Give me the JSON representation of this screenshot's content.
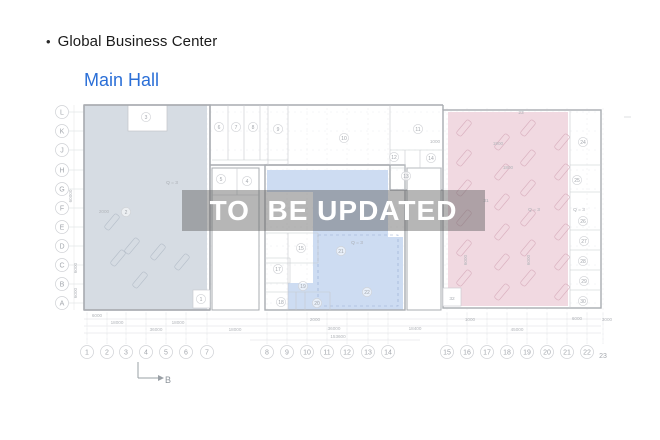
{
  "header": {
    "bullet": "•",
    "title": "Global Business Center",
    "subtitle": "Main Hall",
    "subtitle_color": "#2b6fd7"
  },
  "watermark": {
    "text": "TO  BE UPDATED"
  },
  "plan": {
    "colors": {
      "left_zone": "#d6dce3",
      "mid_zone": "#cddcf2",
      "right_zone": "#f1d9e1",
      "wall": "#a9acb1",
      "partition": "#c6c9cd",
      "grid": "#ebecee",
      "axis_stroke": "#cfd1d5",
      "axis_text": "#a3a7ad",
      "dim_text": "#b2b5ba",
      "note_text": "#a9adb3",
      "hatch_left": "#b6bfca",
      "hatch_pink": "#d9afbe",
      "dash_blue": "#97abd0"
    },
    "row_axis": [
      {
        "label": "L",
        "y": 112
      },
      {
        "label": "K",
        "y": 131
      },
      {
        "label": "J",
        "y": 150
      },
      {
        "label": "H",
        "y": 170
      },
      {
        "label": "G",
        "y": 189
      },
      {
        "label": "F",
        "y": 208
      },
      {
        "label": "E",
        "y": 227
      },
      {
        "label": "D",
        "y": 246
      },
      {
        "label": "C",
        "y": 265
      },
      {
        "label": "B",
        "y": 284
      },
      {
        "label": "A",
        "y": 303
      }
    ],
    "col_axis": [
      {
        "label": "1",
        "x": 87
      },
      {
        "label": "2",
        "x": 107
      },
      {
        "label": "3",
        "x": 126
      },
      {
        "label": "4",
        "x": 146
      },
      {
        "label": "5",
        "x": 166
      },
      {
        "label": "6",
        "x": 186
      },
      {
        "label": "7",
        "x": 207
      },
      {
        "label": "8",
        "x": 267
      },
      {
        "label": "9",
        "x": 287
      },
      {
        "label": "10",
        "x": 307
      },
      {
        "label": "11",
        "x": 327
      },
      {
        "label": "12",
        "x": 347
      },
      {
        "label": "13",
        "x": 368
      },
      {
        "label": "14",
        "x": 388
      },
      {
        "label": "15",
        "x": 447
      },
      {
        "label": "16",
        "x": 467
      },
      {
        "label": "17",
        "x": 487
      },
      {
        "label": "18",
        "x": 507
      },
      {
        "label": "19",
        "x": 527
      },
      {
        "label": "20",
        "x": 547
      },
      {
        "label": "21",
        "x": 567
      },
      {
        "label": "22",
        "x": 587
      },
      {
        "label": "23",
        "x": 603,
        "plain": true
      }
    ],
    "rooms": [
      {
        "n": "1",
        "x": 201,
        "y": 299
      },
      {
        "n": "2",
        "x": 126,
        "y": 212
      },
      {
        "n": "3",
        "x": 146,
        "y": 117
      },
      {
        "n": "4",
        "x": 247,
        "y": 181
      },
      {
        "n": "5",
        "x": 221,
        "y": 179
      },
      {
        "n": "6",
        "x": 219,
        "y": 127
      },
      {
        "n": "7",
        "x": 236,
        "y": 127
      },
      {
        "n": "8",
        "x": 253,
        "y": 127
      },
      {
        "n": "9",
        "x": 278,
        "y": 129
      },
      {
        "n": "10",
        "x": 344,
        "y": 138
      },
      {
        "n": "11",
        "x": 418,
        "y": 129
      },
      {
        "n": "12",
        "x": 394,
        "y": 157
      },
      {
        "n": "13",
        "x": 406,
        "y": 176
      },
      {
        "n": "14",
        "x": 431,
        "y": 158
      },
      {
        "n": "15",
        "x": 301,
        "y": 248
      },
      {
        "n": "17",
        "x": 278,
        "y": 269
      },
      {
        "n": "18",
        "x": 281,
        "y": 302
      },
      {
        "n": "19",
        "x": 303,
        "y": 286
      },
      {
        "n": "20",
        "x": 317,
        "y": 303
      },
      {
        "n": "21",
        "x": 341,
        "y": 251
      },
      {
        "n": "22",
        "x": 367,
        "y": 292
      },
      {
        "n": "24",
        "x": 583,
        "y": 142
      },
      {
        "n": "25",
        "x": 577,
        "y": 180
      },
      {
        "n": "26",
        "x": 583,
        "y": 221
      },
      {
        "n": "27",
        "x": 584,
        "y": 241
      },
      {
        "n": "28",
        "x": 583,
        "y": 261
      },
      {
        "n": "29",
        "x": 584,
        "y": 281
      },
      {
        "n": "30",
        "x": 583,
        "y": 301
      }
    ],
    "notes": [
      {
        "t": "Q = 3",
        "x": 172,
        "y": 184
      },
      {
        "t": "Q = 3",
        "x": 357,
        "y": 244
      },
      {
        "t": "Q = 3",
        "x": 534,
        "y": 211
      },
      {
        "t": "Q = 3",
        "x": 579,
        "y": 211
      },
      {
        "t": "23",
        "x": 521,
        "y": 114
      },
      {
        "t": "31",
        "x": 486,
        "y": 202
      },
      {
        "t": "32",
        "x": 452,
        "y": 300
      }
    ],
    "dims": [
      {
        "t": "6000",
        "x": 97,
        "y": 317
      },
      {
        "t": "18000",
        "x": 117,
        "y": 324
      },
      {
        "t": "18000",
        "x": 178,
        "y": 324
      },
      {
        "t": "36000",
        "x": 156,
        "y": 331
      },
      {
        "t": "18000",
        "x": 235,
        "y": 331
      },
      {
        "t": "2000",
        "x": 315,
        "y": 321
      },
      {
        "t": "36000",
        "x": 334,
        "y": 330
      },
      {
        "t": "153600",
        "x": 338,
        "y": 338
      },
      {
        "t": "18400",
        "x": 415,
        "y": 330
      },
      {
        "t": "45000",
        "x": 517,
        "y": 331
      },
      {
        "t": "1000",
        "x": 470,
        "y": 321
      },
      {
        "t": "6000",
        "x": 577,
        "y": 320
      },
      {
        "t": "3000",
        "x": 607,
        "y": 321
      },
      {
        "t": "2000",
        "x": 104,
        "y": 213
      },
      {
        "t": "1000",
        "x": 435,
        "y": 143
      },
      {
        "t": "1900",
        "x": 498,
        "y": 145
      },
      {
        "t": "1800",
        "x": 508,
        "y": 169
      },
      {
        "t": "60000",
        "x": 72,
        "y": 196,
        "rot": -90
      },
      {
        "t": "6000",
        "x": 77,
        "y": 268,
        "rot": -90
      },
      {
        "t": "6000",
        "x": 77,
        "y": 293,
        "rot": -90
      },
      {
        "t": "6000",
        "x": 467,
        "y": 260,
        "rot": -90
      },
      {
        "t": "6000",
        "x": 530,
        "y": 260,
        "rot": -90
      }
    ],
    "section_marker": {
      "label": "B",
      "x": 168,
      "y": 380
    }
  }
}
